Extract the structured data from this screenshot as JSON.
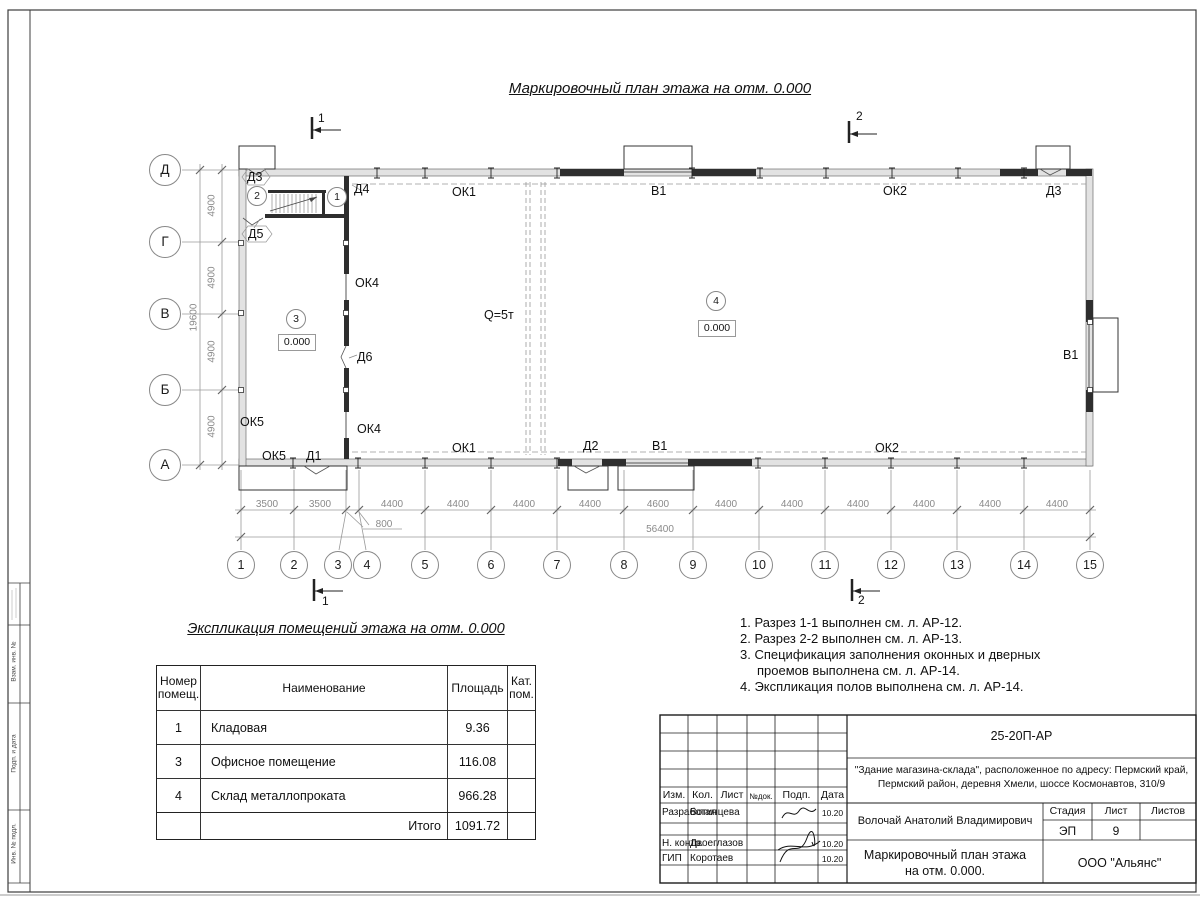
{
  "plan": {
    "title": "Маркировочный план этажа на отм. 0.000",
    "crane": "Q=5т",
    "row_axes": [
      "Д",
      "Г",
      "В",
      "Б",
      "А"
    ],
    "col_axes": [
      "1",
      "2",
      "3",
      "4",
      "5",
      "6",
      "7",
      "8",
      "9",
      "10",
      "11",
      "12",
      "13",
      "14",
      "15"
    ],
    "dims": {
      "bottom": [
        "3500",
        "3500",
        "4400",
        "4400",
        "4400",
        "4400",
        "4600",
        "4400",
        "4400",
        "4400",
        "4400",
        "4400",
        "4400"
      ],
      "offset": "800",
      "total_bottom": "56400",
      "left": [
        "4900",
        "4900",
        "4900",
        "4900"
      ],
      "total_left": "19600"
    },
    "sections": {
      "s1": "1",
      "s2": "2"
    },
    "openings": {
      "d1": "Д1",
      "d2": "Д2",
      "d3a": "Д3",
      "d3b": "Д3",
      "d4": "Д4",
      "d5": "Д5",
      "d6": "Д6",
      "ok1a": "ОК1",
      "ok1b": "ОК1",
      "ok2a": "ОК2",
      "ok2b": "ОК2",
      "ok4a": "ОК4",
      "ok4b": "ОК4",
      "ok5a": "ОК5",
      "ok5b": "ОК5",
      "v1a": "В1",
      "v1b": "В1",
      "v1c": "В1"
    },
    "rooms": {
      "r1": {
        "num": "1"
      },
      "r2": {
        "num": "2"
      },
      "r3": {
        "num": "3",
        "elev": "0.000"
      },
      "r4": {
        "num": "4",
        "elev": "0.000"
      }
    }
  },
  "explication": {
    "title": "Экспликация помещений этажа на отм. 0.000",
    "headers": [
      "Номер помещ.",
      "Наименование",
      "Площадь",
      "Кат. пом."
    ],
    "rows": [
      {
        "num": "1",
        "name": "Кладовая",
        "area": "9.36",
        "cat": ""
      },
      {
        "num": "3",
        "name": "Офисное помещение",
        "area": "116.08",
        "cat": ""
      },
      {
        "num": "4",
        "name": "Склад металлопроката",
        "area": "966.28",
        "cat": ""
      }
    ],
    "total_label": "Итого",
    "total_value": "1091.72"
  },
  "notes": [
    "1. Разрез 1-1 выполнен см. л. АР-12.",
    "2. Разрез 2-2 выполнен см. л. АР-13.",
    "3. Спецификация заполнения оконных и дверных проемов выполнена см. л. АР-14.",
    "4. Экспликация полов выполнена см. л. АР-14."
  ],
  "titleblock": {
    "doc_number": "25-20П-АР",
    "project_line1": "\"Здание магазина-склада\", расположенное по адресу: Пермский край,",
    "project_line2": "Пермский район, деревня Хмели, шоссе Космонавтов, 310/9",
    "cols": [
      "Изм.",
      "Кол.",
      "Лист",
      "№док.",
      "Подп.",
      "Дата"
    ],
    "sign_rows": [
      {
        "role": "Разработал",
        "name": "Вотинцева",
        "date": "10.20"
      },
      {
        "role": "Н. контр.",
        "name": "Двоеглазов",
        "date": "10.20"
      },
      {
        "role": "ГИП",
        "name": "Коротаев",
        "date": "10.20"
      }
    ],
    "chief": "Волочай Анатолий Владимирович",
    "stage_label": "Стадия",
    "sheet_label": "Лист",
    "sheets_label": "Листов",
    "stage": "ЭП",
    "sheet_no": "9",
    "drawing_name": "Маркировочный план этажа на отм. 0.000.",
    "company": "ООО \"Альянс\""
  },
  "frame": {
    "side_labels": [
      "Взам. инв. №",
      "Подп. и дата",
      "Инв. № подл."
    ]
  }
}
